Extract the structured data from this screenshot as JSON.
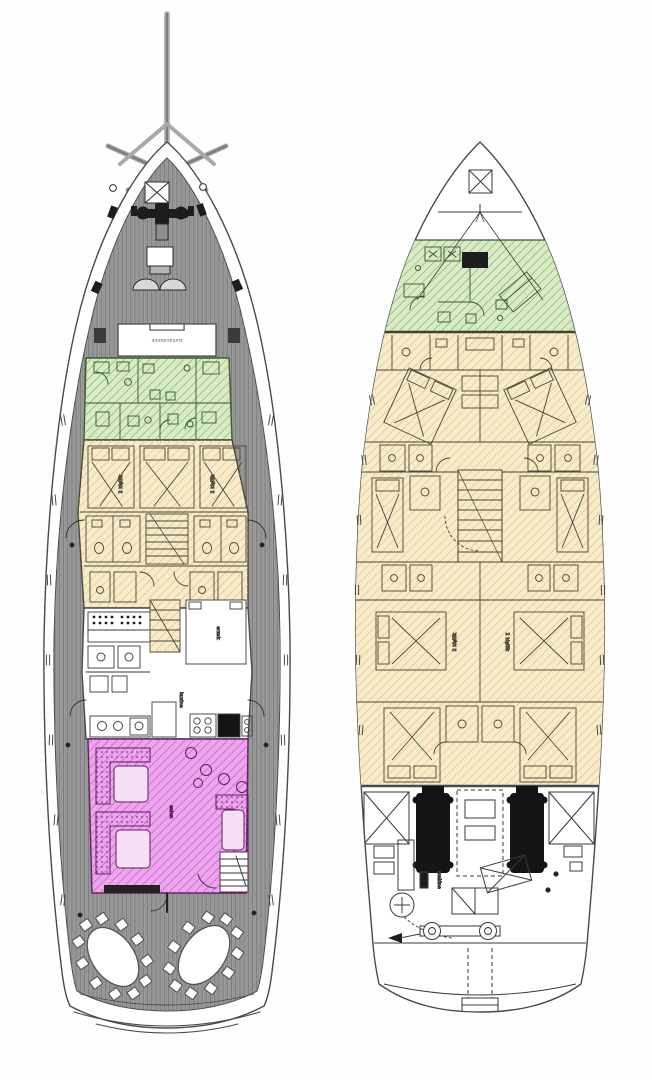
{
  "diagram": {
    "type": "yacht-deck-plans",
    "boats": [
      {
        "name": "main-deck-plan",
        "zones": [
          "foredeck",
          "wheelhouse",
          "crew-quarters",
          "guest-cabins",
          "galley",
          "salon",
          "aft-dining-deck"
        ]
      },
      {
        "name": "lower-deck-plan",
        "zones": [
          "forepeak",
          "crew-quarters",
          "guest-cabins",
          "engine-room"
        ]
      }
    ]
  },
  "labels": {
    "wheelhouse": "kumandanlık",
    "double_cabin": "2 kişilik",
    "storage": "erzak",
    "galley": "kuzine",
    "salon": "salon",
    "engine_room": "makine"
  },
  "colors": {
    "hull_white": "#ffffff",
    "deck_gray": "#9b9b9b",
    "plank_line": "#6f6f6f",
    "outline": "#4a4a4a",
    "crew_green_fill": "#d9ebc5",
    "crew_green_hatch": "#74a361",
    "cabin_yellow_fill": "#f7ecca",
    "cabin_yellow_hatch": "#d8bd85",
    "salon_magenta_fill": "#eca6ed",
    "salon_magenta_hatch": "#c957c9",
    "engine_black": "#141414",
    "furniture_line": "#3a3a3a"
  }
}
